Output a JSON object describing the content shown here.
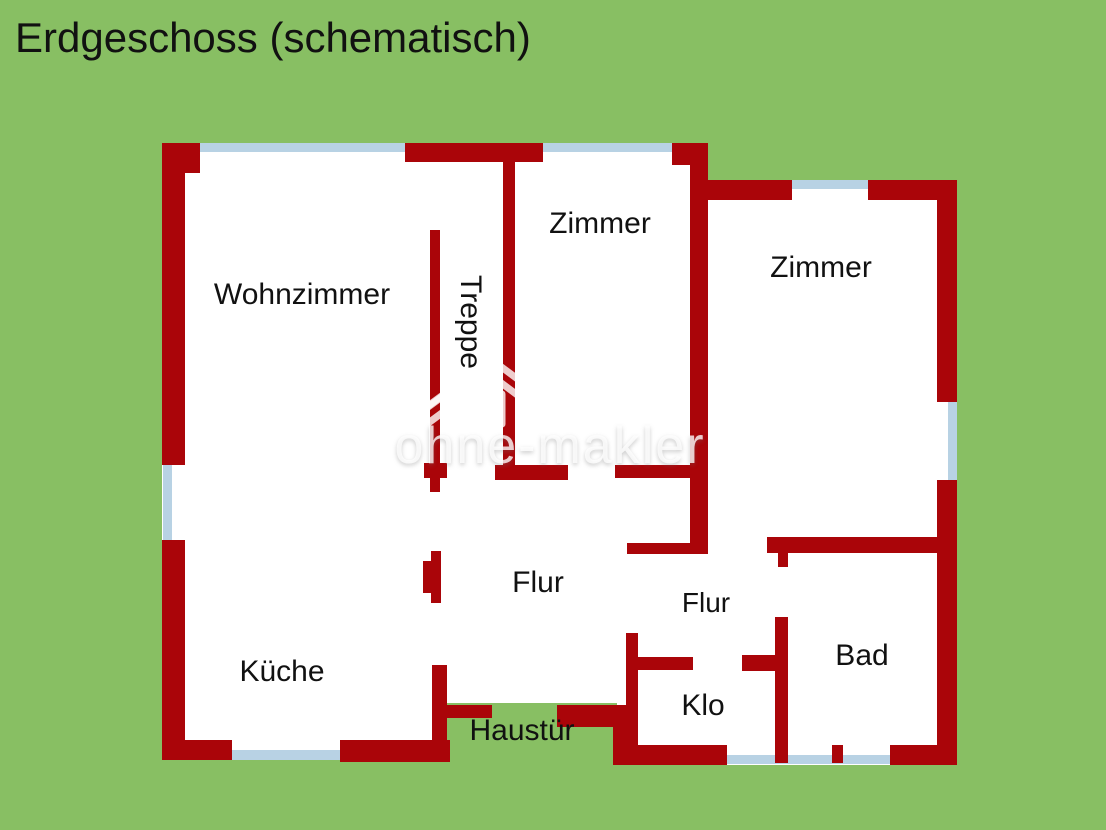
{
  "title": "Erdgeschoss (schematisch)",
  "watermark": {
    "brand": "ohne-makler"
  },
  "colors": {
    "background": "#88bf63",
    "wall": "#aa0509",
    "window_glass": "#b8d2e4",
    "floor": "#ffffff",
    "text": "#111111"
  },
  "rooms": {
    "wohnzimmer": "Wohnzimmer",
    "treppe": "Treppe",
    "zimmer_mitte": "Zimmer",
    "zimmer_rechts": "Zimmer",
    "flur_mitte": "Flur",
    "flur_bad": "Flur",
    "kueche": "Küche",
    "bad": "Bad",
    "klo": "Klo",
    "haustuer": "Haustür"
  }
}
